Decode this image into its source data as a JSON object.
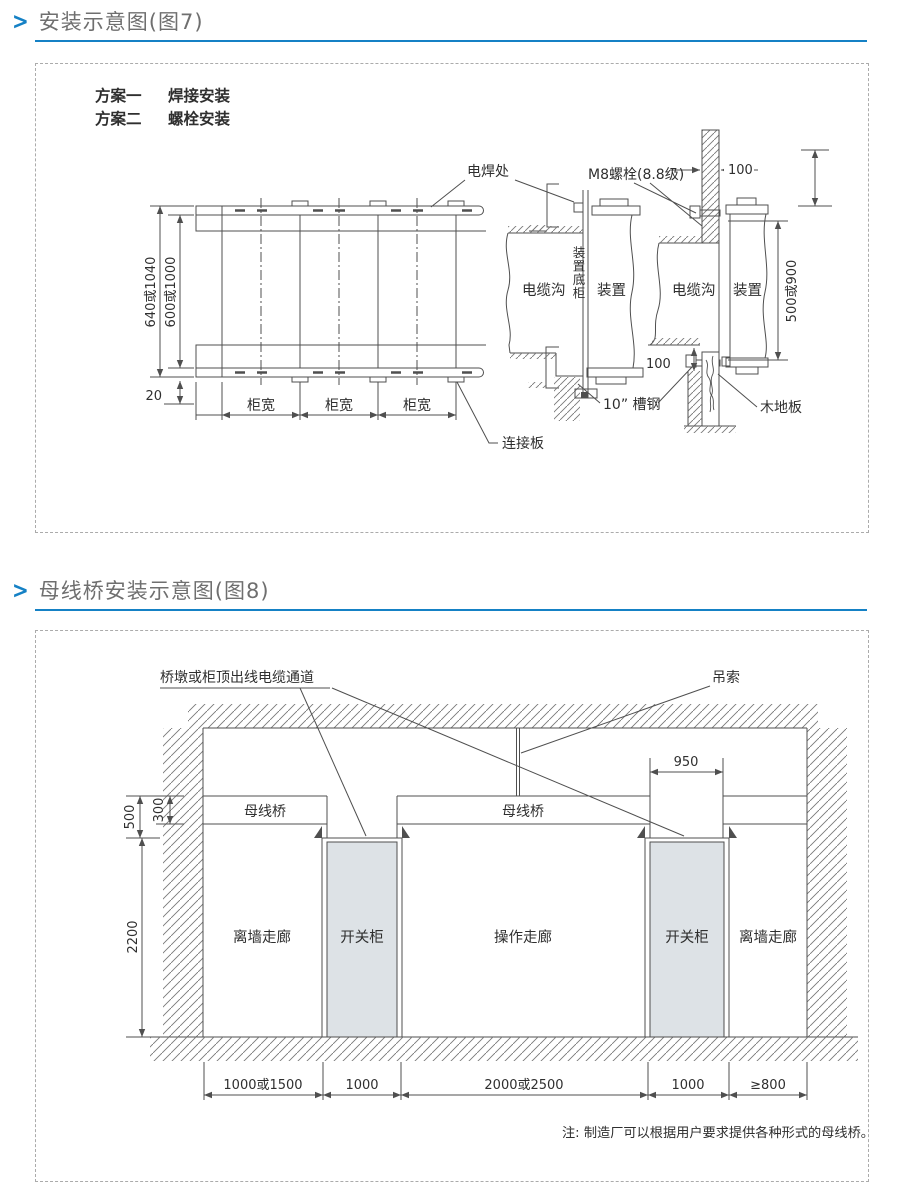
{
  "page": {
    "accent": "#1581c5",
    "marker": ">"
  },
  "sections": [
    {
      "title": "安装示意图(图7)"
    },
    {
      "title": "母线桥安装示意图(图8)"
    }
  ],
  "figure7": {
    "schemes": [
      {
        "label": "方案一",
        "method": "焊接安装"
      },
      {
        "label": "方案二",
        "method": "螺栓安装"
      }
    ],
    "labels": {
      "weld_spot": "电焊处",
      "m8_bolt": "M8螺栓(8.8级)",
      "cable_trench_left": "电缆沟",
      "device_base_cabinet": "装置底柜",
      "device_left": "装置",
      "cable_trench_right": "电缆沟",
      "device_right": "装置",
      "channel_steel": "10” 槽钢",
      "wood_floor": "木地板",
      "connection_plate": "连接板"
    },
    "dims": {
      "outer_height": "640或1040",
      "inner_height": "600或1000",
      "edge_offset": "20",
      "cabinet_widths": [
        "柜宽",
        "柜宽",
        "柜宽"
      ],
      "wall_thickness": "100",
      "floor_gap": "100",
      "device_height": "500或900"
    }
  },
  "figure8": {
    "labels": {
      "cable_channel": "桥墩或柜顶出线电缆通道",
      "sling": "吊索",
      "busbar_bridges": [
        "母线桥",
        "母线桥"
      ],
      "corridor_left": "离墙走廊",
      "corridor_center": "操作走廊",
      "corridor_right": "离墙走廊",
      "switch_cabinets": [
        "开关柜",
        "开关柜"
      ]
    },
    "dims": {
      "pier_width": "950",
      "above_total": "500",
      "bridge_height": "300",
      "room_height": "2200",
      "bottom": [
        "1000或1500",
        "1000",
        "2000或2500",
        "1000",
        "≥800"
      ]
    },
    "note": "注: 制造厂可以根据用户要求提供各种形式的母线桥。"
  }
}
